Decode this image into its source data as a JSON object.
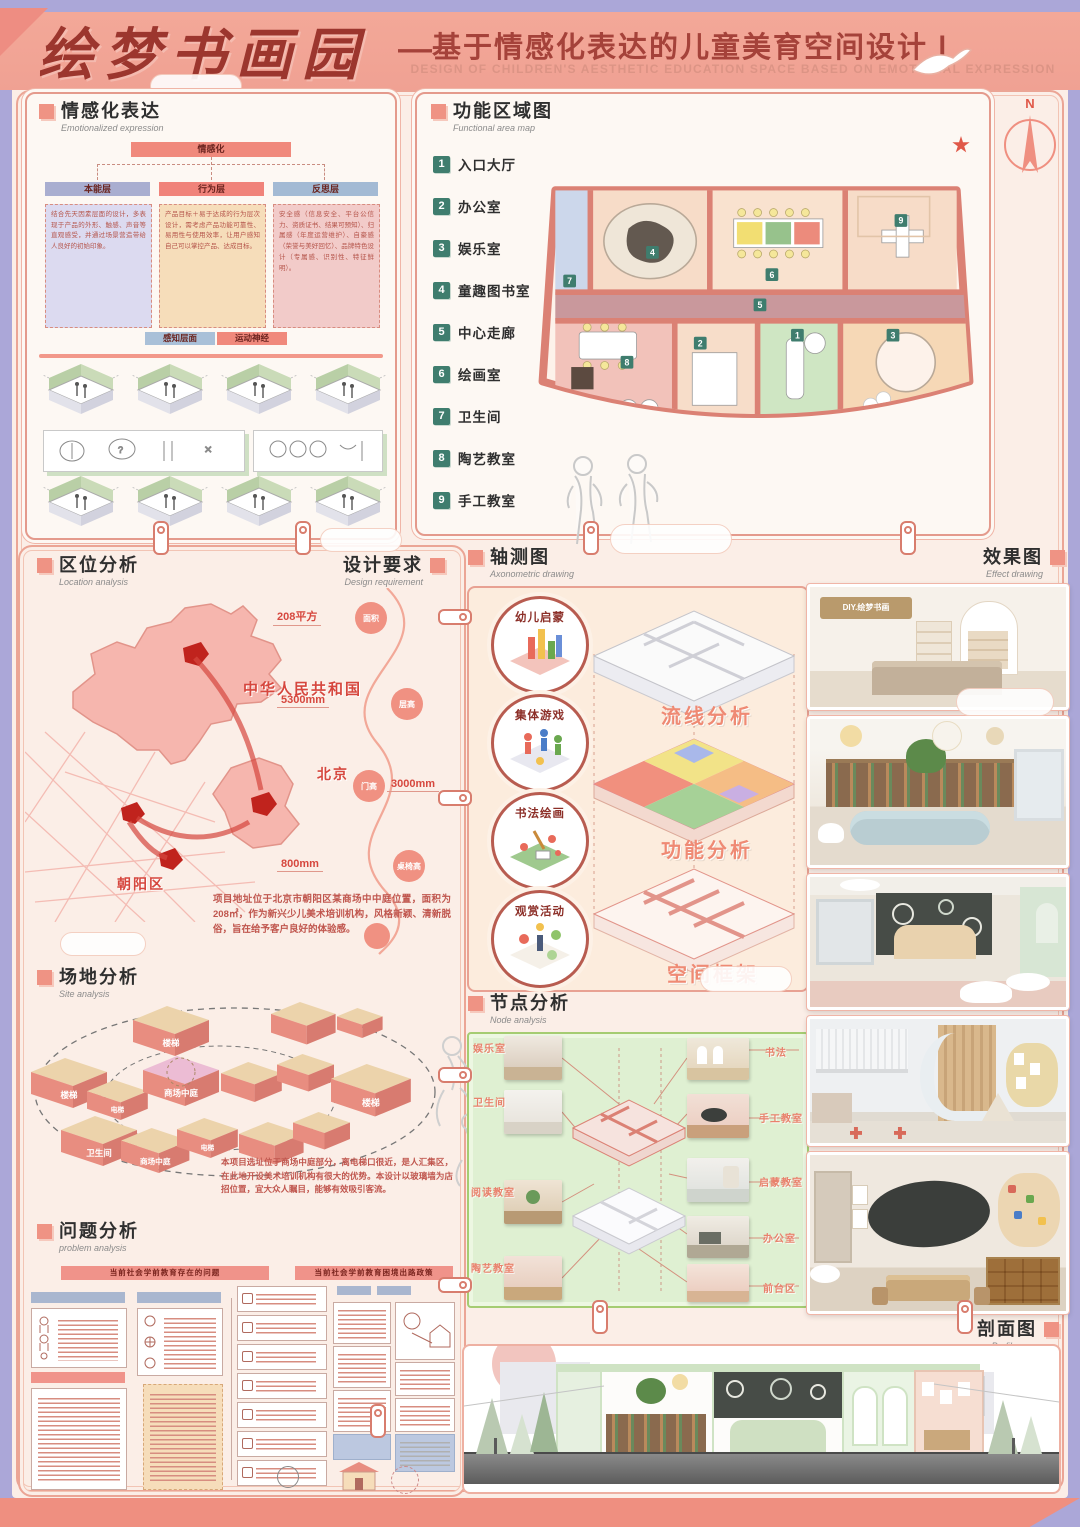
{
  "palette": {
    "lavender": "#aba7d8",
    "salmon_band": "#f0a193",
    "accent_red": "#a5423a",
    "tile_green": "#3f7d6e",
    "node_green": "#dff0d2",
    "panel_border": "#e49a8c"
  },
  "header": {
    "calligraphy": "绘梦书画园",
    "dash": "—",
    "title": "基于情感化表达的儿童美育空间设计 Ⅰ",
    "subtitle_en": "DESIGN OF CHILDREN'S AESTHETIC EDUCATION SPACE BASED ON EMOTIONAL EXPRESSION"
  },
  "emotional": {
    "title": "情感化表达",
    "en": "Emotionalized expression",
    "flow": {
      "top": "情感化",
      "layers": [
        {
          "label": "本能层",
          "body": "结合先天因素层面的设计，多表现于产品的外形、触感、声音等直观感受，并通过场景营造带给人良好的初始印象。"
        },
        {
          "label": "行为层",
          "body": "产品目标＋易于达成的行为层次设计，需考虑产品功能可靠性、易用性与使用效率，让用户感知自己可以掌控产品、达成目标。"
        },
        {
          "label": "反思层",
          "body": "安全感（信息安全、平台公信力、资质证书、结果可预知）、归属感（年度运营维护）、自豪感（荣誉与美好回忆）、品牌特色设计（专属感、识别性、特征鲜明）。"
        }
      ],
      "bottom": [
        {
          "label": "感知层面"
        },
        {
          "label": "运动神经"
        }
      ]
    }
  },
  "functional": {
    "title": "功能区域图",
    "en": "Functional area map",
    "compass": "N",
    "legend": [
      {
        "num": "1",
        "label": "入口大厅"
      },
      {
        "num": "2",
        "label": "办公室"
      },
      {
        "num": "3",
        "label": "娱乐室"
      },
      {
        "num": "4",
        "label": "童趣图书室"
      },
      {
        "num": "5",
        "label": "中心走廊"
      },
      {
        "num": "6",
        "label": "绘画室"
      },
      {
        "num": "7",
        "label": "卫生间"
      },
      {
        "num": "8",
        "label": "陶艺教室"
      },
      {
        "num": "9",
        "label": "手工教室"
      }
    ]
  },
  "location": {
    "title": "区位分析",
    "en": "Location analysis",
    "country": "中华人民共和国",
    "city": "北京",
    "district": "朝阳区",
    "description": "项目地址位于北京市朝阳区某商场中中庭位置，面积为208㎡，作为新兴少儿美术培训机构，风格新颖、清新脱俗，旨在给予客户良好的体验感。"
  },
  "requirement": {
    "title": "设计要求",
    "en": "Design requirement",
    "items": [
      {
        "label": "面积",
        "value": "208平方"
      },
      {
        "label": "层高",
        "value": "5300mm"
      },
      {
        "label": "门高",
        "value": "3000mm"
      },
      {
        "label": "桌椅高",
        "value": "800mm"
      }
    ]
  },
  "site": {
    "title": "场地分析",
    "en": "Site analysis",
    "blocks": [
      "楼梯",
      "楼梯",
      "电梯",
      "商场中庭",
      "楼梯",
      "商场中庭",
      "卫生间",
      "电梯"
    ],
    "description": "本项目选址位于商场中庭部分，离电梯口很近，是人汇集区，在此地开设美术培训机构有很大的优势。本设计以玻璃墙为店招位置，宜大众人瞩目，能够有效吸引客流。"
  },
  "problem": {
    "title": "问题分析",
    "en": "problem analysis",
    "left_header": "当前社会学前教育存在的问题",
    "right_header": "当前社会学前教育困境出路政策"
  },
  "axonometric": {
    "title": "轴测图",
    "en": "Axonometric drawing",
    "circles": [
      "幼儿启蒙",
      "集体游戏",
      "书法绘画",
      "观赏活动"
    ],
    "labels": [
      "流线分析",
      "功能分析",
      "空间框架"
    ]
  },
  "node": {
    "title": "节点分析",
    "en": "Node analysis",
    "left_labels": [
      "娱乐室",
      "卫生间",
      "阅读教室",
      "陶艺教室"
    ],
    "right_labels": [
      "书法",
      "手工教室",
      "启蒙教室",
      "办公室",
      "前台区"
    ]
  },
  "effect": {
    "title": "效果图",
    "en": "Effect drawing",
    "sign": "DIY.绘梦书画"
  },
  "profile": {
    "title": "剖面图",
    "en": "Profile map"
  }
}
